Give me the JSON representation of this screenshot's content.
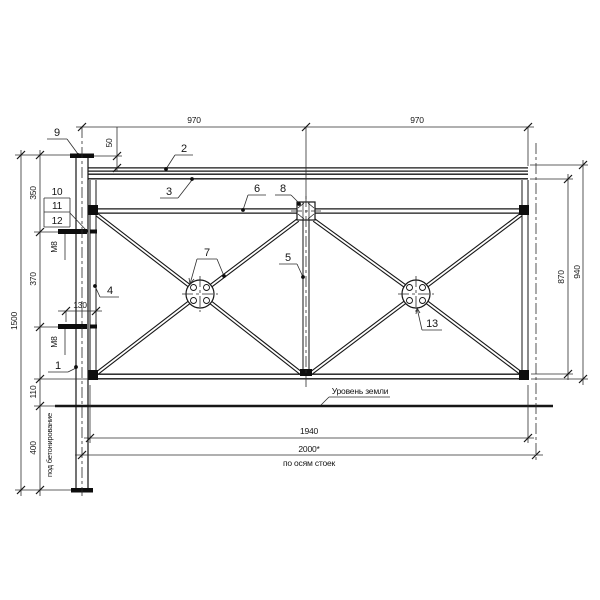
{
  "drawing": {
    "top": {
      "span_left": "970",
      "span_right": "970",
      "rail_offset": "50"
    },
    "left": {
      "total_height": "1500",
      "seg_350": "350",
      "seg_370": "370",
      "seg_110": "110",
      "seg_400": "400",
      "bolt_length": "130",
      "bolt_upper": "М8",
      "bolt_lower": "М8",
      "embed_note": "под бетонирование"
    },
    "right": {
      "panel_height": "870",
      "overall_height": "940"
    },
    "bottom": {
      "clear_span": "1940",
      "axis_span": "2000*",
      "axis_note": "по осям стоек"
    },
    "ground": {
      "label": "Уровень земли"
    },
    "callouts": {
      "c1": "1",
      "c2": "2",
      "c3": "3",
      "c4": "4",
      "c5": "5",
      "c6": "6",
      "c7": "7",
      "c8": "8",
      "c9": "9",
      "c10": "10",
      "c11": "11",
      "c12": "12",
      "c13": "13"
    }
  }
}
